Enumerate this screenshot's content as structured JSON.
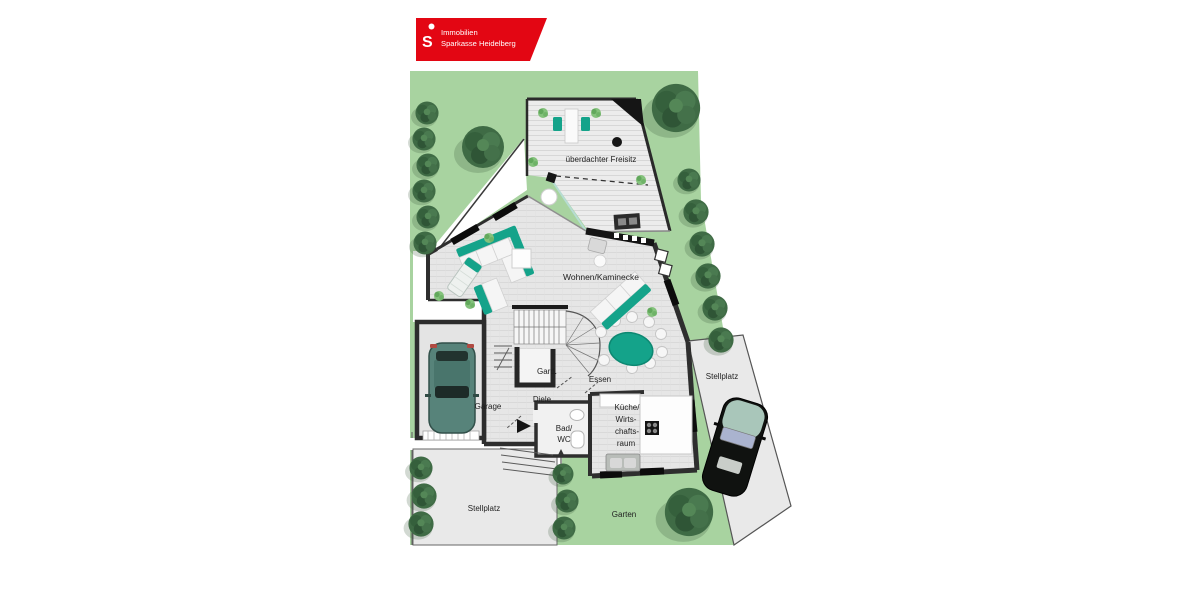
{
  "logo": {
    "line1": "Immobilien",
    "line2": "Sparkasse Heidelberg",
    "symbol": "sparkasse-s-icon",
    "symbol_glyph": "S"
  },
  "labels": {
    "freisitz": "überdachter Freisitz",
    "wohnen": "Wohnen/Kaminecke",
    "gard": "Gard.",
    "essen": "Essen",
    "diele": "Diele",
    "garage": "Garage",
    "bad_line1": "Bad/",
    "bad_line2": "WC",
    "kueche_line1": "Küche/",
    "kueche_line2": "Wirts-",
    "kueche_line3": "chafts-",
    "kueche_line4": "raum",
    "stellplatz_right": "Stellplatz",
    "stellplatz_bottom": "Stellplatz",
    "garten": "Garten"
  },
  "colors": {
    "brand_red": "#e30613",
    "garden_green": "#a8d3a0",
    "deck_gray": "#ececec",
    "floor_gray": "#e6e6e6",
    "parking_gray": "#e9e9e9",
    "wall_dark": "#2e2e2e",
    "accent_teal": "#14a38a",
    "tree_green": "#3f6b45",
    "car_garage_body": "#57837a",
    "car_street_body": "#101210"
  }
}
